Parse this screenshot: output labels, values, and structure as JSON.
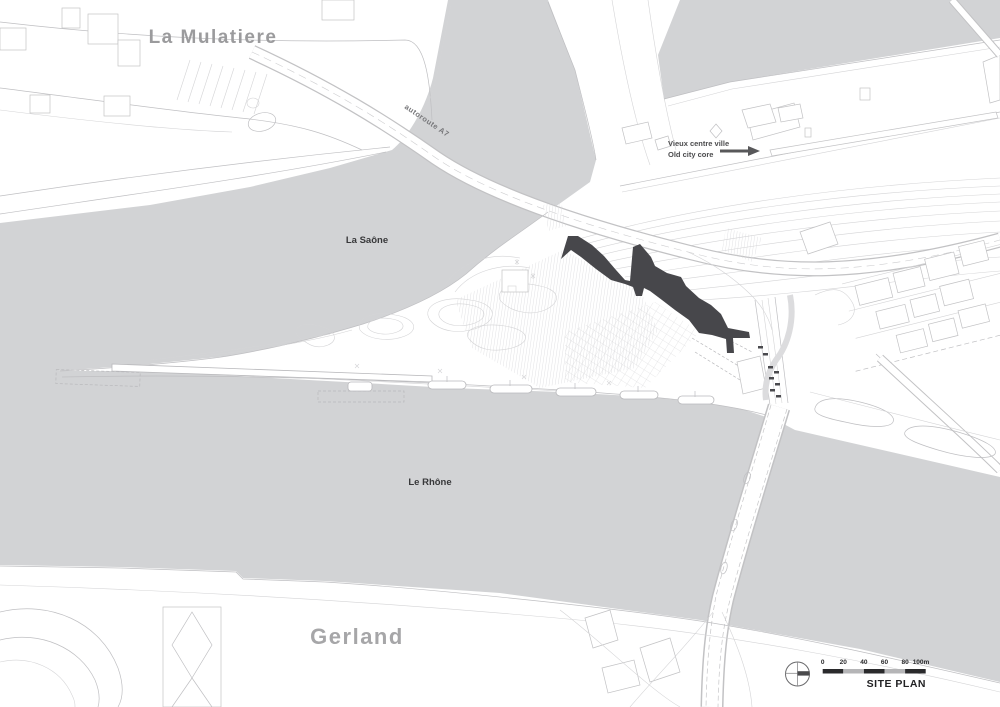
{
  "map": {
    "labels": {
      "district_top": "La Mulatiere",
      "district_bottom": "Gerland",
      "river_upper": "La Saône",
      "river_lower": "Le Rhône",
      "annotation_fr": "Vieux centre ville",
      "annotation_en": "Old city core",
      "road": "autoroute A7"
    },
    "scale_bar": {
      "ticks": [
        "0",
        "20",
        "40",
        "60",
        "80",
        "100m"
      ],
      "caption": "SITE PLAN"
    },
    "icons": {
      "north_indicator": "crosshair-circle-icon",
      "old_city_arrow": "right-arrow-icon"
    },
    "colors": {
      "water": "#d2d3d5",
      "museum_building": "#47474b",
      "linework": "#bfbfc2",
      "district_label": "#9b9b9d",
      "river_label": "#38383a",
      "annotation_label": "#4c4c4e",
      "scale_black": "#2a2a2c",
      "scale_gray": "#b5b5b7"
    }
  }
}
